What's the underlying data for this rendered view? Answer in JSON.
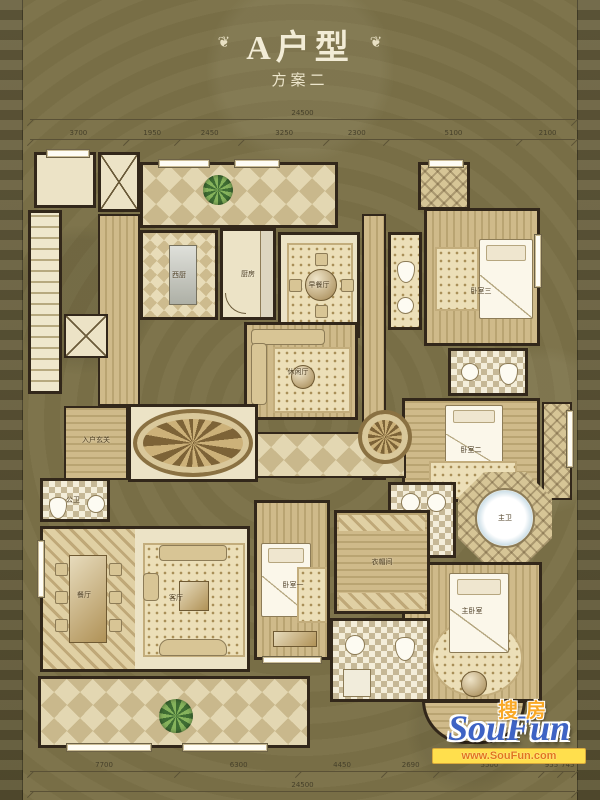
{
  "title": {
    "main": "A户型",
    "sub": "方案二",
    "ornament_left": "❦",
    "ornament_right": "❦"
  },
  "dims": {
    "top": {
      "total": "24500",
      "segments": [
        "3700",
        "1950",
        "2450",
        "3250",
        "2300",
        "5100",
        "2100"
      ]
    },
    "bottom": {
      "total": "24500",
      "segments": [
        "7700",
        "6300",
        "4450",
        "2690",
        "5500",
        "955",
        "745"
      ]
    }
  },
  "rooms": {
    "foyer": "入户玄关",
    "powder": "公卫",
    "west_kitchen": "西厨",
    "kitchen": "厨房",
    "breakfast": "早餐厅",
    "leisure": "休闲厅",
    "dining": "餐厅",
    "living": "客厅",
    "bed1": "卧室一",
    "bed2": "卧室二",
    "bed3": "卧室三",
    "closet": "衣帽间",
    "master": "主卧室",
    "master_bath": "主卫"
  },
  "watermark": {
    "cn": "搜房",
    "en": "SouFun",
    "url": "www.SouFun.com"
  },
  "colors": {
    "background": "#7b7148",
    "side_band": "#635a39",
    "wall": "#32271a",
    "floor": "#ece3c6",
    "title_text": "#f2ecd6",
    "dim_text": "#46402a",
    "watermark_blue": "#3e63c4",
    "watermark_orange": "#f9a826",
    "watermark_bar": "#ffdf4d"
  }
}
